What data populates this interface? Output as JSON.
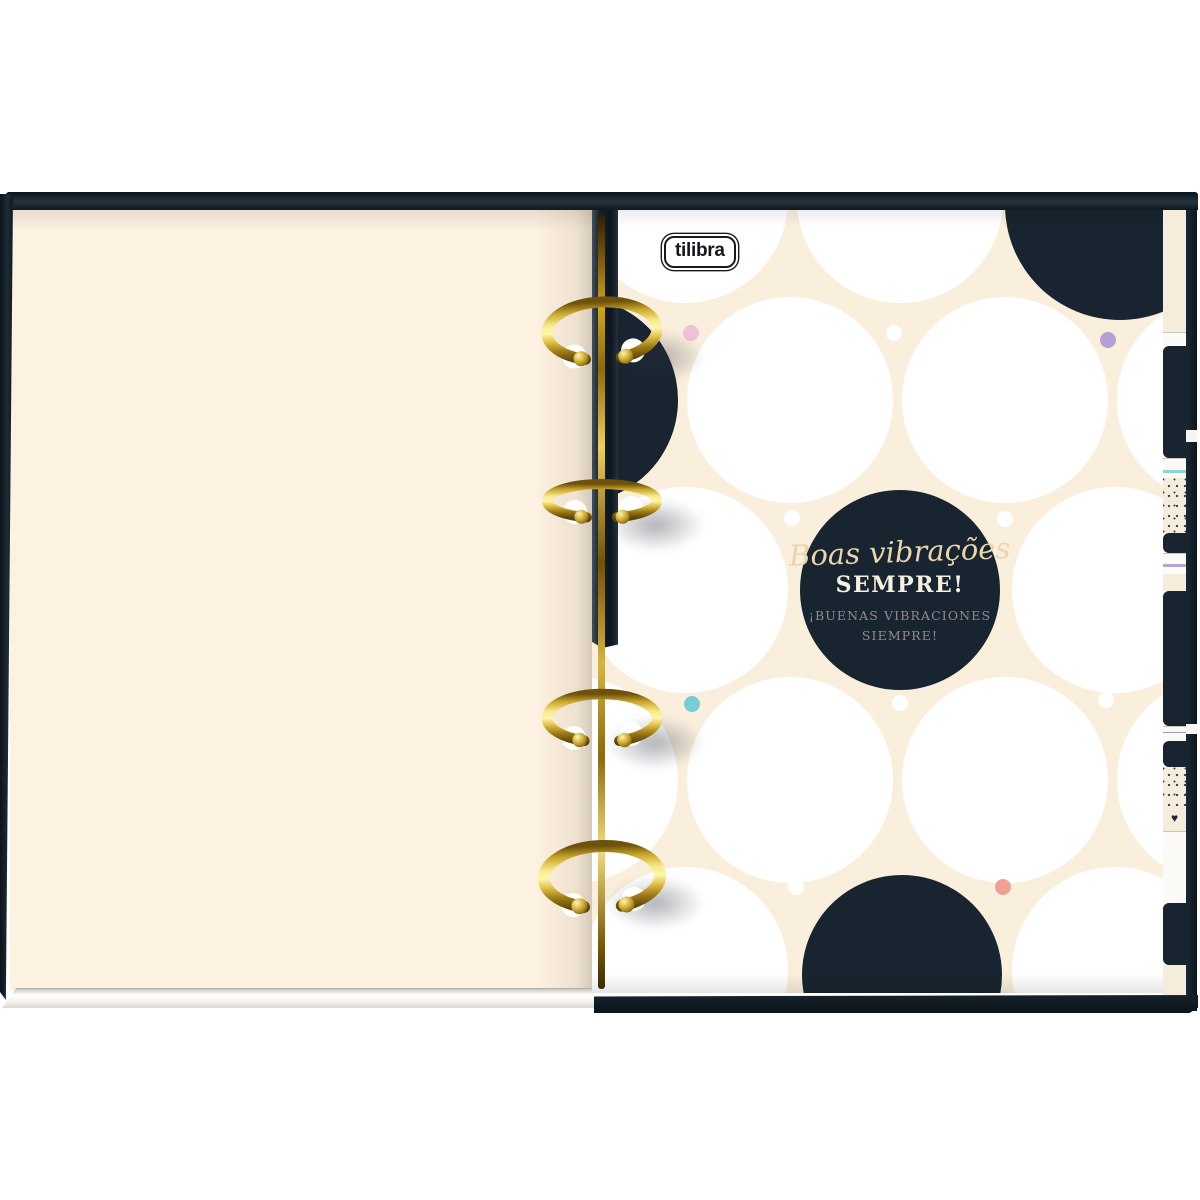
{
  "theme": {
    "page_cream": "#fdf1e1",
    "pattern_cream": "#faeedd",
    "circle_white": "#ffffff",
    "navy_circle": "#18242f",
    "cover_black": "#0e1820",
    "gold": "#caa62c",
    "script_text": "#e9d6ae",
    "emphasis_text": "#f6f0e3",
    "subtitle_text": "#95888e",
    "dot_pink": "#f0c2d6",
    "dot_purple": "#b5a0d6",
    "dot_teal": "#79ccd4",
    "dot_coral": "#efa193",
    "dot_white": "#ffffff",
    "tab_teal_line": "#8fd2d8",
    "tab_purple_line": "#b4a4d4"
  },
  "binder": {
    "brand": {
      "logo_text": "tilibra"
    },
    "message_circle": {
      "script_line": "Boas vibrações",
      "emphasis_line": "SEMPRE!",
      "subtitle_line_1": "¡BUENAS VIBRACIONES",
      "subtitle_line_2": "SIEMPRE!"
    },
    "rings": {
      "count": 4
    },
    "tabs": {
      "heart_glyph": "♥"
    }
  }
}
